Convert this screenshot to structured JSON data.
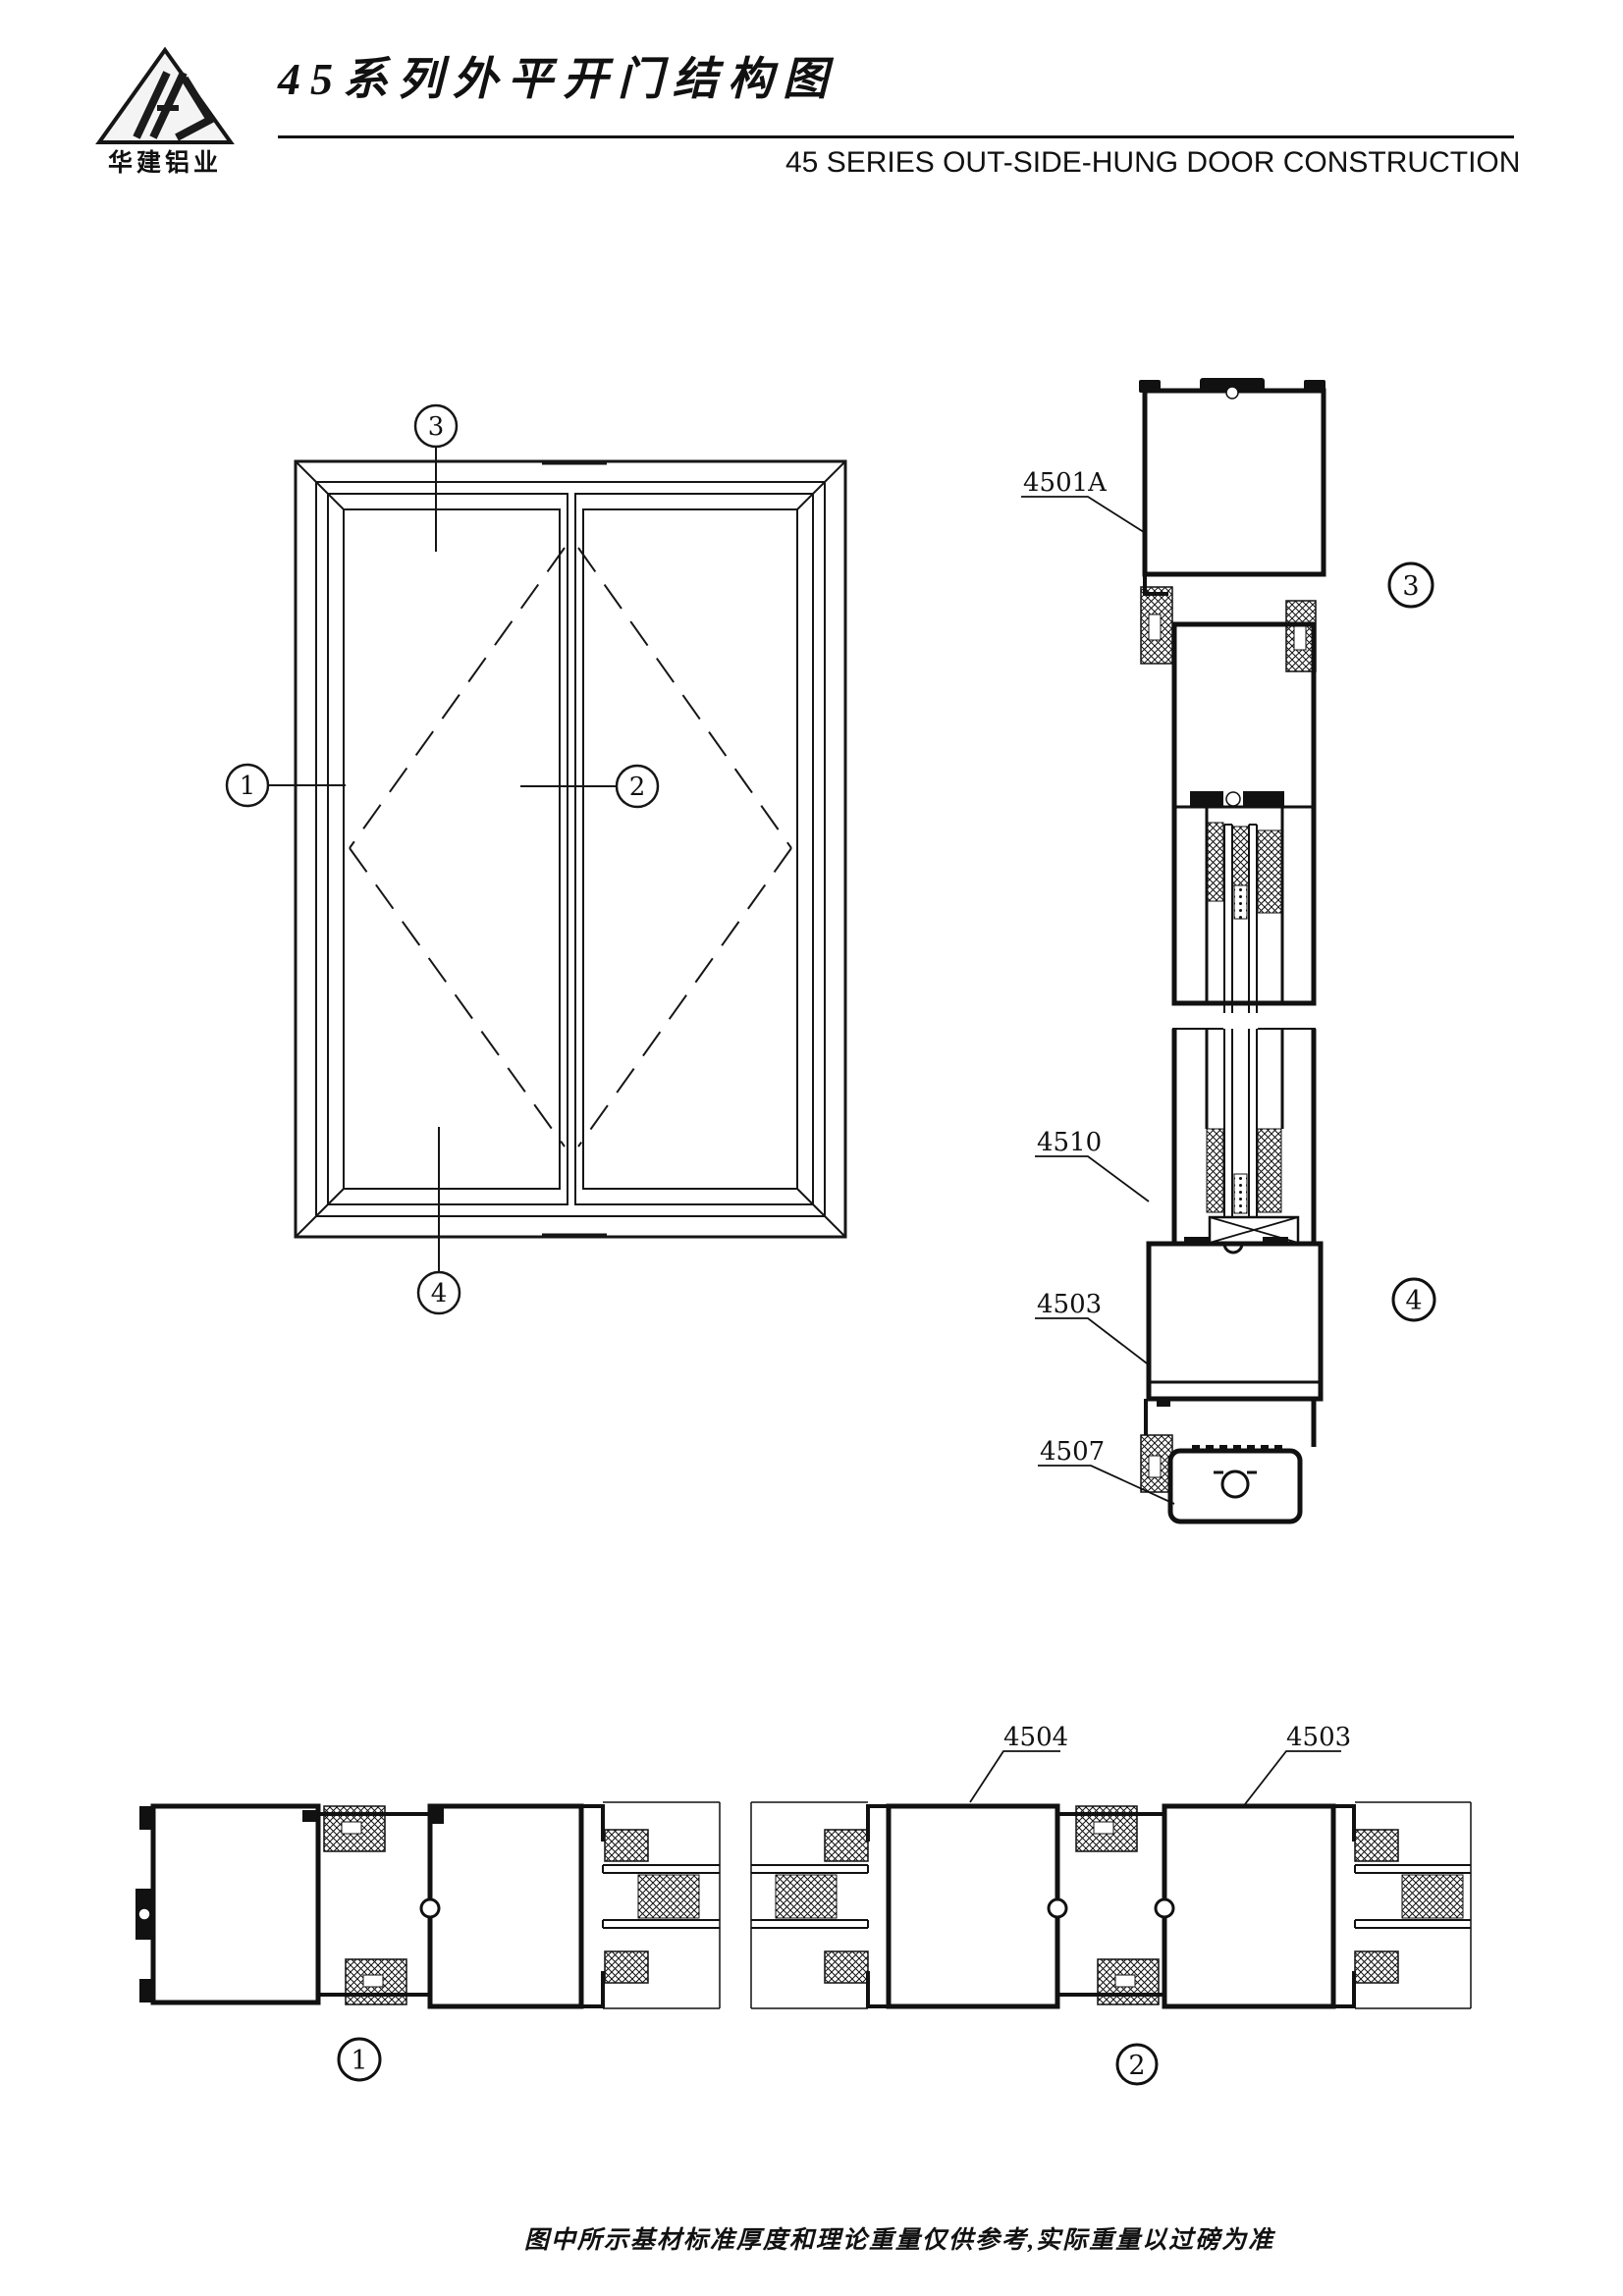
{
  "header": {
    "logo_name": "华建铝业",
    "title_cn": "45系列外平开门结构图",
    "title_en": "45 SERIES OUT-SIDE-HUNG DOOR CONSTRUCTION"
  },
  "figures": {
    "elevation": {
      "callout_top": "3",
      "callout_left": "1",
      "callout_center": "2",
      "callout_bottom": "4"
    },
    "vertical_section": {
      "label_frame_head": "4501A",
      "label_glazing_bead": "4510",
      "label_sash_bottom": "4503",
      "label_threshold": "4507",
      "detail_top": "3",
      "detail_bottom": "4"
    },
    "horizontal_sections": {
      "label_left_stile": "4504",
      "label_right_stile": "4503",
      "detail_left": "1",
      "detail_right": "2"
    }
  },
  "footer": {
    "note": "图中所示基材标准厚度和理论重量仅供参考,实际重量以过磅为准"
  },
  "colors": {
    "ink": "#111111",
    "paper": "#ffffff"
  }
}
